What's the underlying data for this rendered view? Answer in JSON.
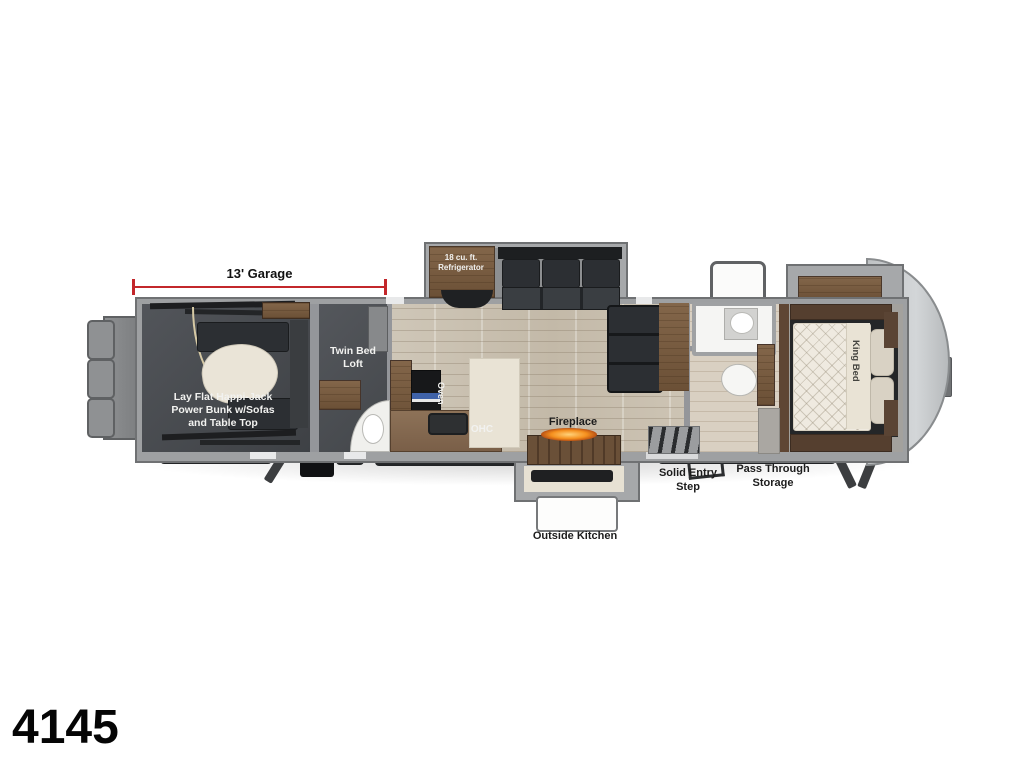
{
  "model": "4145",
  "dimension": {
    "label": "13' Garage",
    "color": "#c3272b"
  },
  "labels": {
    "bunk": [
      "Lay Flat Happi-Jack",
      "Power Bunk w/Sofas",
      "and Table Top"
    ],
    "loft": [
      "Twin Bed",
      "Loft"
    ],
    "fridge": [
      "18 cu. ft.",
      "Refrigerator"
    ],
    "oven": "Oven",
    "ohc": "OHC",
    "fireplace": "Fireplace",
    "king_bed": "King Bed",
    "entry_step": [
      "Solid Entry",
      "Step"
    ],
    "pass_through": [
      "Pass Through",
      "Storage"
    ],
    "outside_kitchen": "Outside Kitchen"
  },
  "colors": {
    "dimension_red": "#c3272b",
    "wall_gray": "#9ea0a2",
    "garage_floor": "#46494d",
    "wood_floor": "#c9c0b1",
    "cabinet_brown": "#6b4e38",
    "counter_brown": "#7a5f48",
    "dark_furniture": "#2c2f33",
    "mattress_cream": "#efeae0",
    "fire_orange": "#f5901e",
    "front_cap_gray": "#c6c9cb"
  }
}
